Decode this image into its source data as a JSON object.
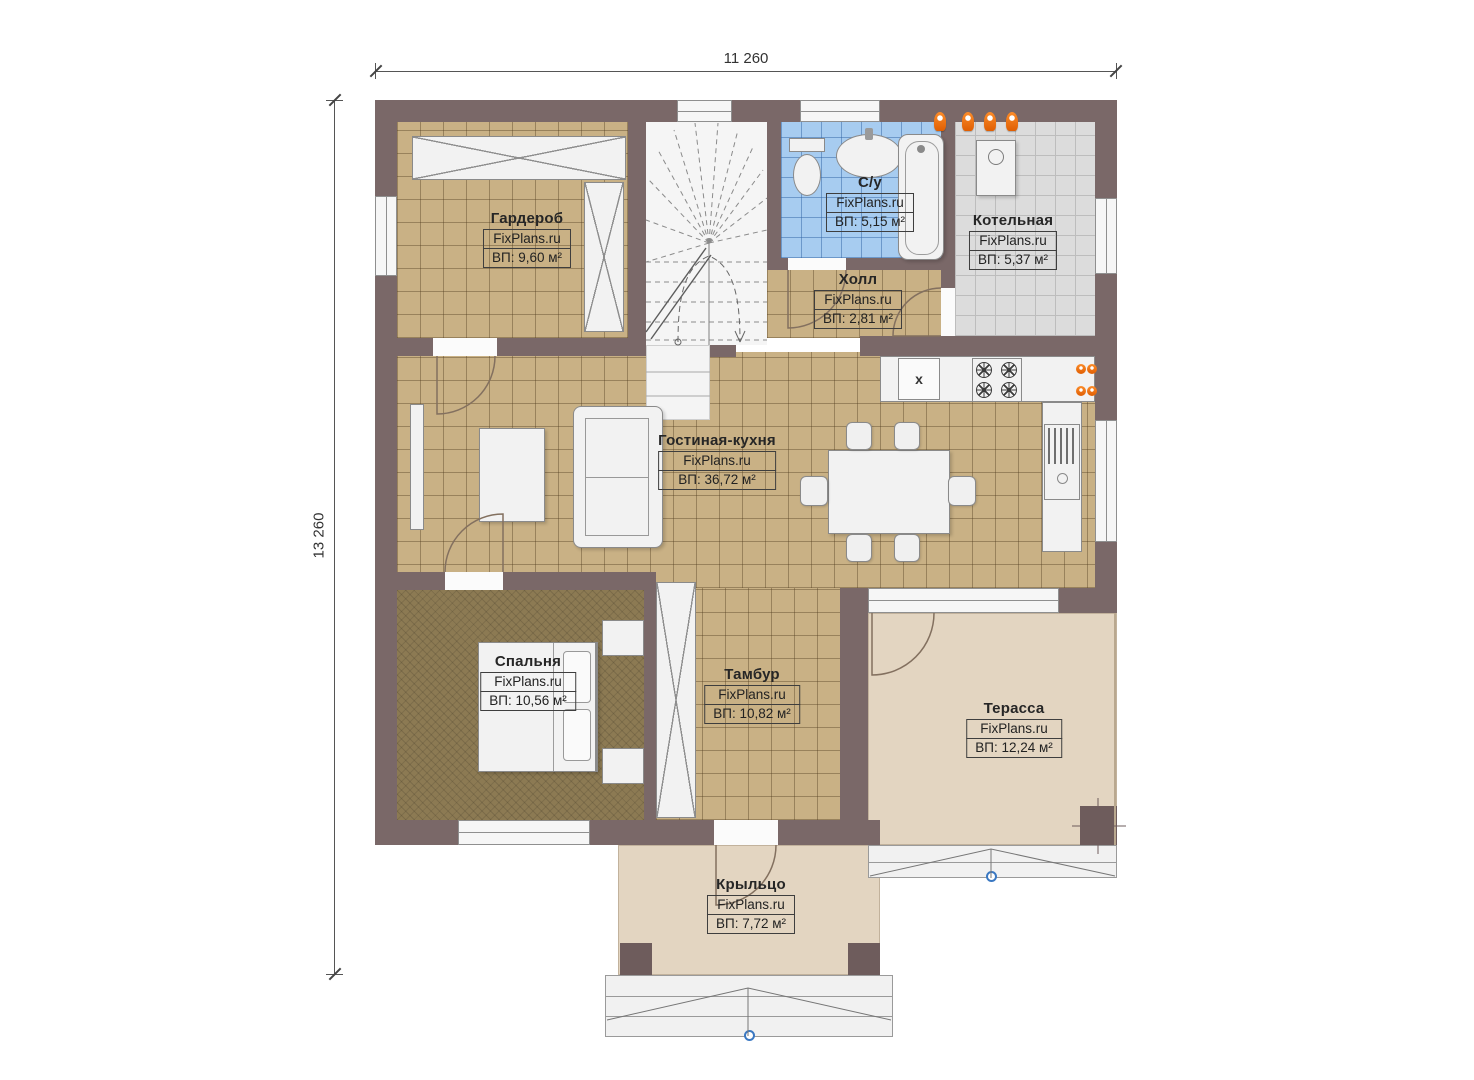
{
  "watermark": "FixPlans.ru",
  "dimensions": {
    "top": "11 260",
    "left": "13 260"
  },
  "rooms": [
    {
      "name": "Гардероб",
      "brand": "FixPlans.ru",
      "area": "ВП: 9,60 м²"
    },
    {
      "name": "С/у",
      "brand": "FixPlans.ru",
      "area": "ВП: 5,15 м²"
    },
    {
      "name": "Котельная",
      "brand": "FixPlans.ru",
      "area": "ВП: 5,37 м²"
    },
    {
      "name": "Холл",
      "brand": "FixPlans.ru",
      "area": "ВП: 2,81 м²"
    },
    {
      "name": "Гостиная-кухня",
      "brand": "FixPlans.ru",
      "area": "ВП: 36,72 м²"
    },
    {
      "name": "Спальня",
      "brand": "FixPlans.ru",
      "area": "ВП: 10,56 м²"
    },
    {
      "name": "Тамбур",
      "brand": "FixPlans.ru",
      "area": "ВП: 10,82 м²"
    },
    {
      "name": "Терасса",
      "brand": "FixPlans.ru",
      "area": "ВП: 12,24 м²"
    },
    {
      "name": "Крыльцо",
      "brand": "FixPlans.ru",
      "area": "ВП: 7,72 м²"
    }
  ],
  "fixtures": {
    "kitchen_sink_symbol": "x"
  },
  "colors": {
    "wall": "#7a6868",
    "tile_tan": "#c9b185",
    "tile_blue": "#a7ccf0",
    "tile_gray": "#dcdcdc",
    "floor_bedroom": "#8c7a53",
    "terrace": "#e3d5c1",
    "radiator": "#f07413",
    "marker_blue": "#3a78c2"
  }
}
